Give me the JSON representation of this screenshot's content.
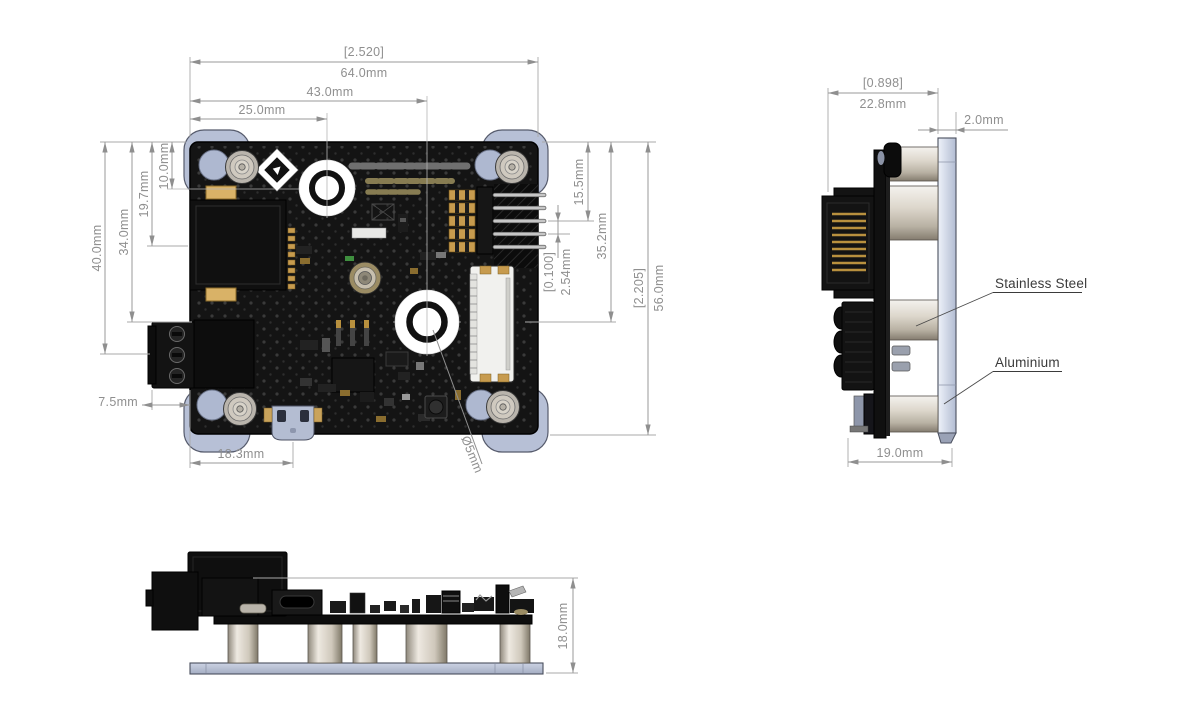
{
  "drawing": {
    "views": {
      "top": {
        "dims": {
          "overall_width_in": "[2.520]",
          "overall_width_mm": "64.0mm",
          "hole2_offset": "43.0mm",
          "hole1_offset": "25.0mm",
          "left_40": "40.0mm",
          "left_34": "34.0mm",
          "left_19_7": "19.7mm",
          "left_10": "10.0mm",
          "terminal_overhang": "7.5mm",
          "usb_offset": "18.3mm",
          "pin_row_offset": "15.5mm",
          "hole2_vertical": "35.2mm",
          "pin_pitch_in": "[0.100]",
          "pin_pitch_mm": "2.54mm",
          "overall_height_in": "[2.205]",
          "overall_height_mm": "56.0mm",
          "hole_diameter": "Ø5mm"
        }
      },
      "side": {
        "dims": {
          "overall_depth_in": "[0.898]",
          "overall_depth_mm": "22.8mm",
          "plate_thickness": "2.0mm",
          "standoff_depth": "19.0mm"
        },
        "labels": {
          "standoff_material": "Stainless Steel",
          "plate_material": "Aluminium"
        }
      },
      "front": {
        "dims": {
          "overall_height": "18.0mm"
        }
      }
    },
    "colors": {
      "dimension_text": "#8f8f8f",
      "material_label": "#3b3b3b",
      "aluminium_plate": "#b7c0d6",
      "stainless_standoff": "#d8d2c6",
      "pcb": "#141414",
      "gold_contacts": "#c79b4e",
      "background": "#ffffff"
    }
  }
}
